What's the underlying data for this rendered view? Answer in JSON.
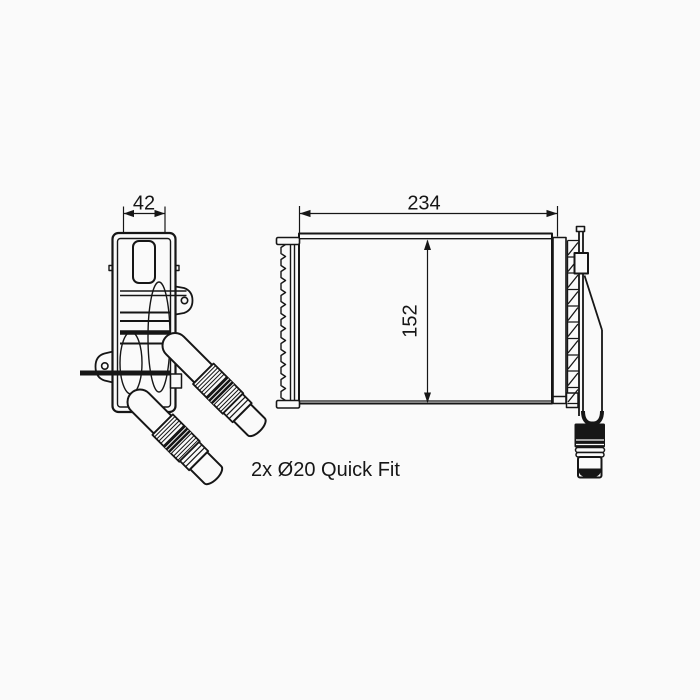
{
  "drawing": {
    "type": "technical-part-drawing",
    "part": "heater-core-with-quick-fit-connectors",
    "dimensions": {
      "depth": "42",
      "width": "234",
      "height": "152"
    },
    "annotation": "2x Ø20 Quick Fit",
    "colors": {
      "line": "#161616",
      "background": "#fafafa"
    }
  }
}
